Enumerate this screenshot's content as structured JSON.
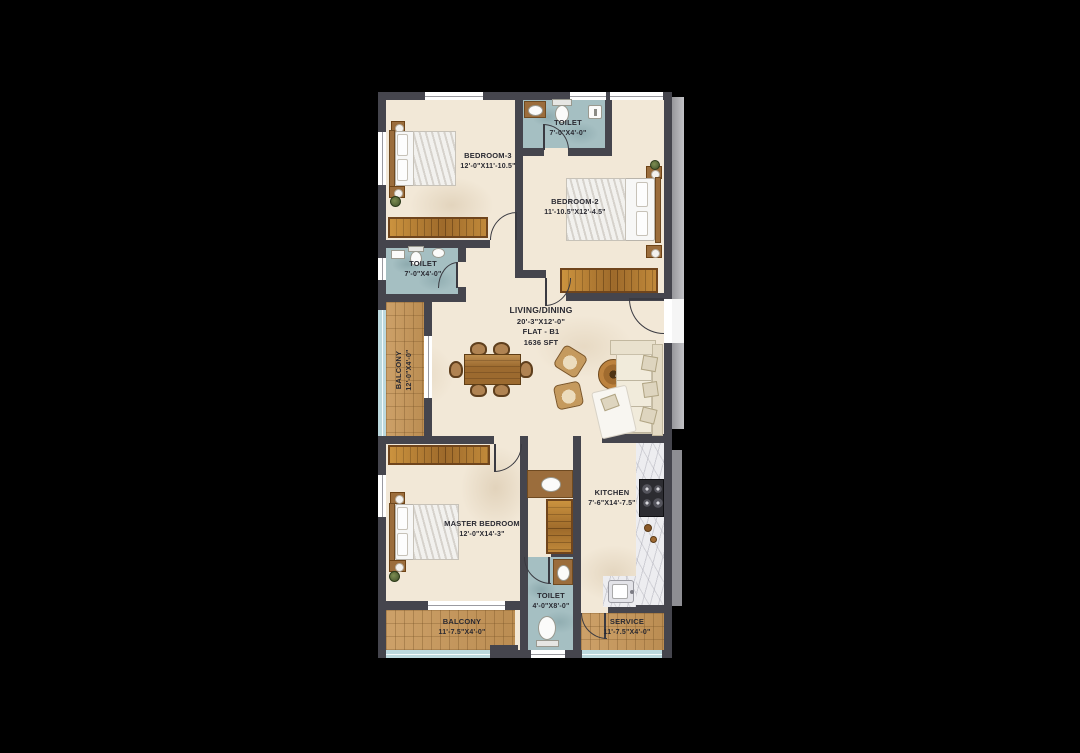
{
  "flat": {
    "label": "FLAT - B1",
    "area": "1636 SFT"
  },
  "rooms": {
    "bedroom3": {
      "name": "BEDROOM-3",
      "dims": "12'-0\"X11'-10.5\""
    },
    "toilet_top": {
      "name": "TOILET",
      "dims": "7'-0\"X4'-0\""
    },
    "bedroom2": {
      "name": "BEDROOM-2",
      "dims": "11'-10.5\"X12'-4.5\""
    },
    "toilet_mid": {
      "name": "TOILET",
      "dims": "7'-0\"X4'-0\""
    },
    "balcony_left": {
      "name": "BALCONY",
      "dims": "12'-0\"X4'-0\""
    },
    "living": {
      "name": "LIVING/DINING",
      "dims": "20'-3\"X12'-0\""
    },
    "kitchen": {
      "name": "KITCHEN",
      "dims": "7'-6\"X14'-7.5\""
    },
    "master_bedroom": {
      "name": "MASTER BEDROOM",
      "dims": "12'-0\"X14'-3\""
    },
    "toilet_master": {
      "name": "TOILET",
      "dims": "4'-0\"X8'-0\""
    },
    "balcony_bottom": {
      "name": "BALCONY",
      "dims": "11'-7.5\"X4'-0\""
    },
    "service": {
      "name": "SERVICE",
      "dims": "11'-7.5\"X4'-0\""
    }
  },
  "colors": {
    "background": "#000000",
    "wall": "#45454d",
    "floor": "#f2e8d7",
    "toilet_floor": "#a5bfc2",
    "wood_floor": "#c79b60",
    "glazing": "#bcd9de",
    "label_text": "#292931"
  }
}
